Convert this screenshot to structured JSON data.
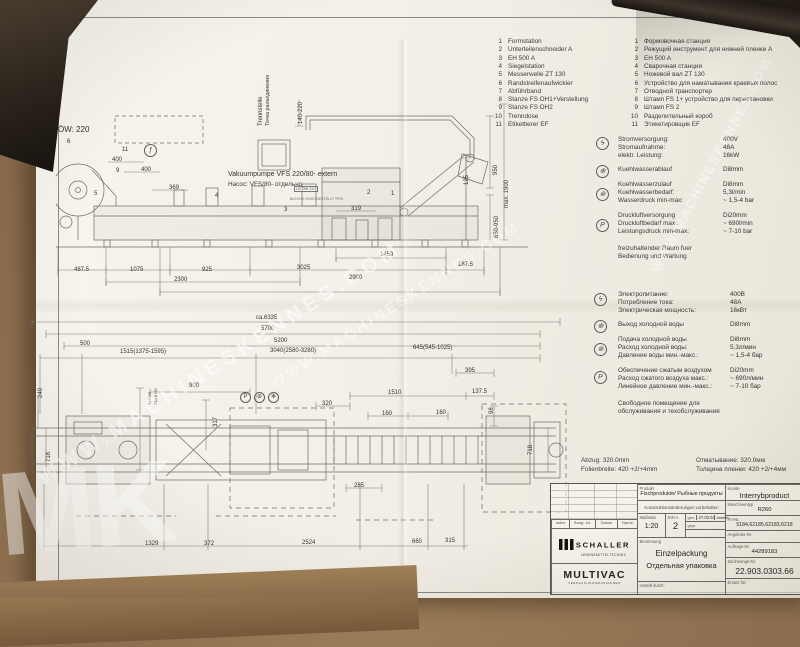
{
  "legend": {
    "items": [
      {
        "n": "1",
        "de": "Formstation",
        "ru": "Формовочная станция"
      },
      {
        "n": "2",
        "de": "Unterteilenschneider A",
        "ru": "Режущий инструмент для нижней пленки A"
      },
      {
        "n": "3",
        "de": "EH 500 A",
        "ru": "EH 500 A"
      },
      {
        "n": "4",
        "de": "Siegelstation",
        "ru": "Сварочная станция"
      },
      {
        "n": "5",
        "de": "Messerwelle ZT 130",
        "ru": "Ножевой вал ZT 130"
      },
      {
        "n": "6",
        "de": "Randstreifenaufwickler",
        "ru": "Устройство для наматывания краевых полос"
      },
      {
        "n": "7",
        "de": "Abführband",
        "ru": "Отводной транспортер"
      },
      {
        "n": "8",
        "de": "Stanze FS OH1+Verstellung",
        "ru": "Штамп FS 1+ устройство для перестановки"
      },
      {
        "n": "9",
        "de": "Stanze FS OH2",
        "ru": "Штамп FS 2"
      },
      {
        "n": "10",
        "de": "Trenndose",
        "ru": "Разделительный короб"
      },
      {
        "n": "11",
        "de": "Etikettierer EF",
        "ru": "Этикетировщик EF"
      }
    ]
  },
  "specs_de": {
    "rows": [
      {
        "label": "Stromversorgung:",
        "value": "400V"
      },
      {
        "label": "Stromaufnahme:",
        "value": "48A"
      },
      {
        "label": "elektr. Leistung:",
        "value": "16kW"
      },
      {
        "label": "Kuehlwasserablauf",
        "value": "Di8mm"
      },
      {
        "label": "Kuehlwasserzulauf",
        "value": "Di8mm"
      },
      {
        "label": "Kuehlwasserbedarf:",
        "value": "5,3l/min"
      },
      {
        "label": "Wasserdruck min-max:",
        "value": "~ 1,5-4 bar"
      },
      {
        "label": "Druckluftversorgung",
        "value": "Di20mm"
      },
      {
        "label": "Druckluftbedarf max :",
        "value": "~ 690l/min"
      },
      {
        "label": "Leistungsdruck min-max:",
        "value": "~ 7-10 bar"
      }
    ],
    "note1": "freizuhaltender Raum fuer",
    "note2": "Bedienung und Wartung"
  },
  "specs_ru": {
    "rows": [
      {
        "label": "Электропитание:",
        "value": "400В"
      },
      {
        "label": "Потребление тока:",
        "value": "48A"
      },
      {
        "label": "Электрическая мощность:",
        "value": "16кВт"
      },
      {
        "label": "Выход холодной воды",
        "value": "Di8mm"
      },
      {
        "label": "Подача холодной воды",
        "value": "Di8mm"
      },
      {
        "label": "Расход холодной воды:",
        "value": "5,3л/мин"
      },
      {
        "label": "Давление воды  мин.-макс.:",
        "value": "~ 1,5-4 бар"
      },
      {
        "label": "Обеспечение сжатым воздухом",
        "value": "Di20mm"
      },
      {
        "label": "Расход сжатого воздуха макс.:",
        "value": "~ 690л/мин"
      },
      {
        "label": "Линейное давление мин.-макс.:",
        "value": "~ 7-10 бар"
      }
    ],
    "note1": "Свободное помещение для",
    "note2": "обслуживания и техобслуживания"
  },
  "icons": {
    "electric": "ϟ",
    "water_out": "⊕",
    "water_in": "⊛",
    "pressure": "P",
    "func": "ƒ",
    "fan": "✻"
  },
  "dt": {
    "ow": "ÖW: 220",
    "pump_de": "Vakuumpumpe VFS 220/80- extern",
    "pump_ru": "Насос: VFS/80- отдельно",
    "note_box": "LB ÖW 220",
    "note_small": "BLECHE HOCHGESTELLT TPIS",
    "sep_de": "Trennstelle",
    "sep_ru": "Точка разъединения",
    "d140": "140-220",
    "n1": "1",
    "n2": "2",
    "n3": "3",
    "n4": "4",
    "n5": "5",
    "n6": "6",
    "n9": "9",
    "n11": "11",
    "d400a": "400",
    "d400b": "400",
    "d369": "369",
    "d319": "319",
    "d125": "125",
    "d950": "950",
    "d1900": "max. 1900",
    "d850": "850-950",
    "d1459": "1459",
    "d4875": "487.5",
    "d1075": "1075",
    "d925": "925",
    "d2300": "2300",
    "d3025": "3025",
    "d2900": "2900",
    "d1875": "187.5"
  },
  "db": {
    "d6335": "ca.6335",
    "d5700": "5700",
    "d5200": "5200",
    "d500": "500",
    "d1515": "1515(1375-1595)",
    "d3040": "3040(2580-3280)",
    "d645": "645(545-1025)",
    "d900": "900",
    "d317": "317",
    "d715": "715 HS",
    "d7186": "718.6 HS",
    "d320": "320",
    "d1510": "1510",
    "d160a": "160",
    "d160b": "160",
    "d395": "395",
    "d1375": "137.5",
    "d98": "98",
    "d718l": "718",
    "d240": "240",
    "d718r": "718",
    "d285": "285",
    "d1329": "1329",
    "d372": "372",
    "d2524": "2524",
    "d660": "660",
    "d315": "315"
  },
  "film": {
    "de1": "Abzug: 320.0mm",
    "de2": "Folienbreite: 420 +2/+4mm",
    "ru1": "Отматывание: 320.0мм",
    "ru2": "Толщина пленки: 420 +2/+4мм"
  },
  "tb": {
    "produkt_label": "Produkt",
    "produkt": "Fischprodukte/ Рыбные продукты",
    "kunde_label": "Kunde",
    "kunde": "Interrybproduct",
    "maschine_label": "Maschinentyp",
    "maschine": "R260",
    "aender_note": "Konstruktionsänderungen vorbehalten",
    "massstab_label": "Maßstab",
    "massstab": "1:20",
    "din_label": "DIN A",
    "din": "2",
    "gez_label": "gez.",
    "gez_date": "27.03.03",
    "gez_name": "Immler",
    "gepr_label": "gepr.",
    "po_label": "Po-Nr.",
    "po": "5184,62185,62183,6218",
    "angebot_label": "Angebots-Nr.",
    "auftrag_label": "Auftrags-Nr.",
    "auftrag": "44289183",
    "zeichnung_label": "Zeichnungs-Nr.",
    "zeichnung": "22.903.0303.66",
    "ersatz_label": "Ersatz für:",
    "benennung_label": "Benennung",
    "benennung_de": "Einzelpackung",
    "benennung_ru": "Отдельная упаковка",
    "erstellt_label": "erstellt durch:",
    "rev": {
      "c1": "Index",
      "c2": "Ändg.-Nr.",
      "c3": "Datum",
      "c4": "Name"
    },
    "schaller": "SCHALLER",
    "schaller_sub": "LEBENSMITTELTECHNIK",
    "multivac": "MULTIVAC",
    "multivac_sub": "VERPACKUNGSMASCHINEN"
  },
  "wm": {
    "site": "WWW.MACHINESKENNES.COM",
    "big": "MK"
  }
}
